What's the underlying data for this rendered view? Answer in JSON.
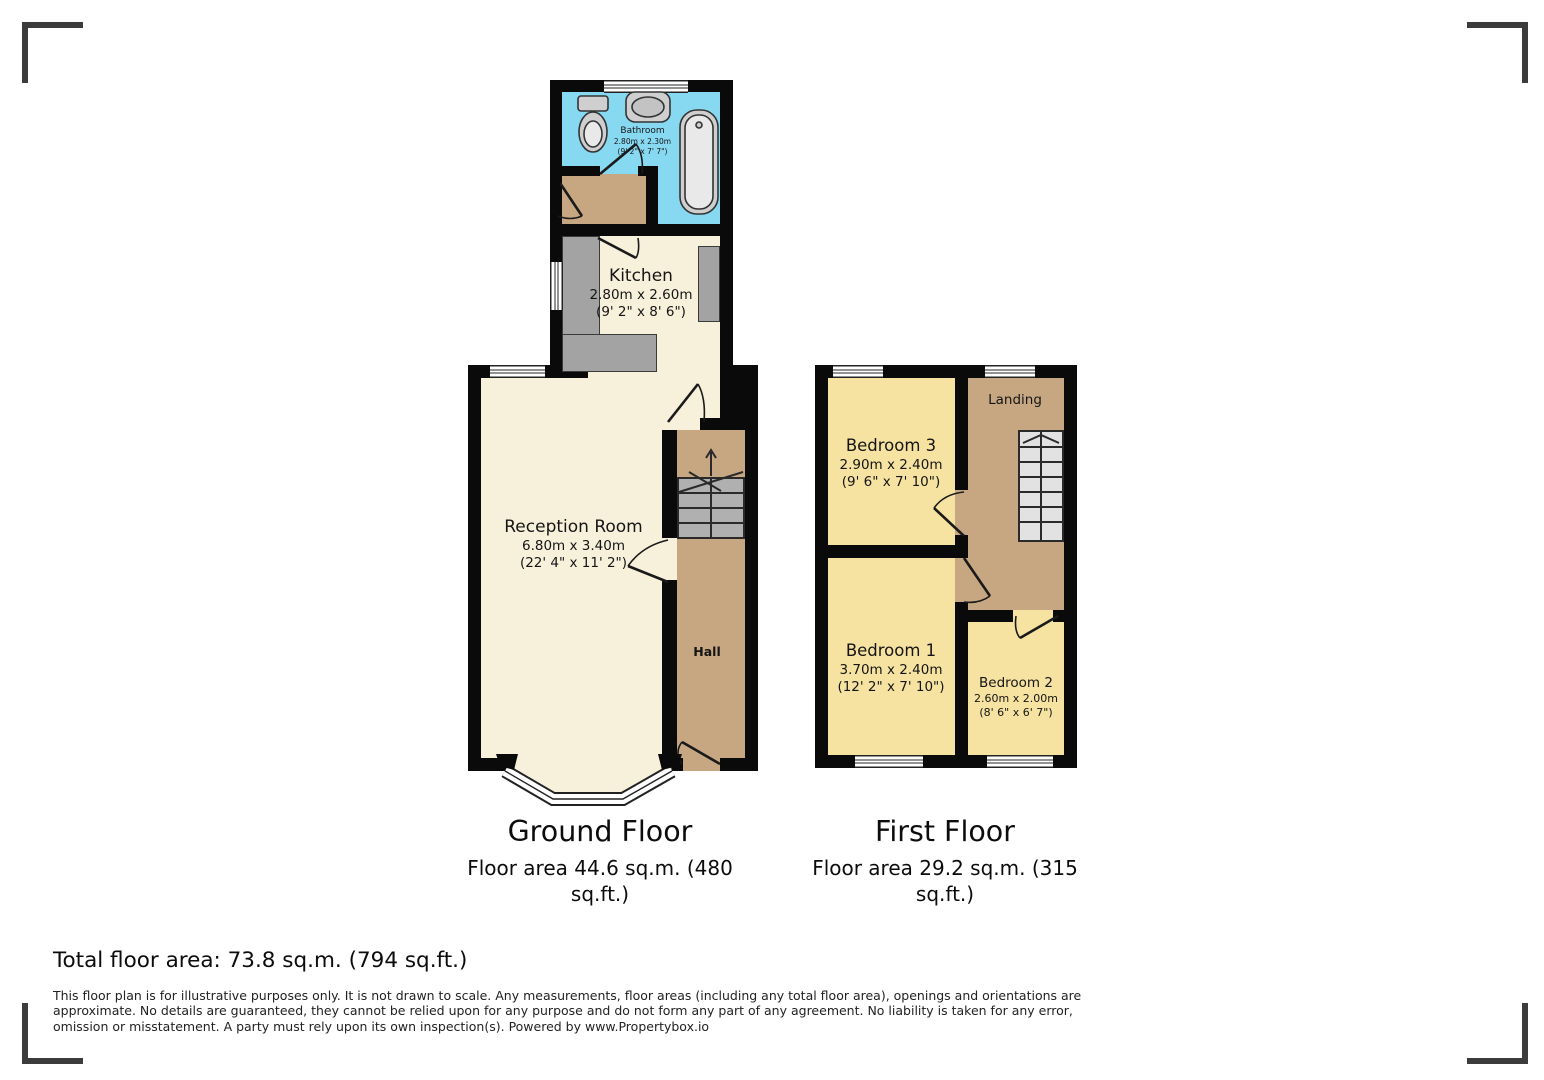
{
  "colors": {
    "wall": "#0a0a0a",
    "bathroom_blue": "#87d9f2",
    "floor_cream": "#f7f1dc",
    "bedroom_yellow": "#f6e3a1",
    "hall_tan": "#c7a682",
    "counter_gray": "#a3a3a3",
    "stair_gray": "#b0b0b0",
    "stair_light": "#e2e2e2",
    "crop_mark_gray": "#3c3c3c"
  },
  "ground_floor": {
    "title": "Ground Floor",
    "area": "Floor area 44.6 sq.m. (480 sq.ft.)",
    "rooms": {
      "bathroom": {
        "name": "Bathroom",
        "metric": "2.80m x 2.30m",
        "imperial": "(9' 2\" x 7' 7\")"
      },
      "kitchen": {
        "name": "Kitchen",
        "metric": "2.80m x 2.60m",
        "imperial": "(9' 2\" x 8' 6\")"
      },
      "reception": {
        "name": "Reception Room",
        "metric": "6.80m x 3.40m",
        "imperial": "(22' 4\" x 11' 2\")"
      },
      "hall": {
        "name": "Hall"
      }
    }
  },
  "first_floor": {
    "title": "First Floor",
    "area": "Floor area 29.2 sq.m. (315 sq.ft.)",
    "rooms": {
      "bedroom3": {
        "name": "Bedroom 3",
        "metric": "2.90m x 2.40m",
        "imperial": "(9' 6\" x 7' 10\")"
      },
      "landing": {
        "name": "Landing"
      },
      "bedroom1": {
        "name": "Bedroom 1",
        "metric": "3.70m x 2.40m",
        "imperial": "(12' 2\" x 7' 10\")"
      },
      "bedroom2": {
        "name": "Bedroom 2",
        "metric": "2.60m x 2.00m",
        "imperial": "(8' 6\" x 6' 7\")"
      }
    }
  },
  "footer": {
    "total_area": "Total floor area: 73.8 sq.m. (794 sq.ft.)",
    "disclaimer": "This floor plan is for illustrative purposes only. It is not drawn to scale. Any measurements, floor areas (including any total floor area), openings and orientations are approximate. No details are guaranteed, they cannot be relied upon for any purpose and do not form any part of any agreement. No liability is taken for any error, omission or misstatement. A party must rely upon its own inspection(s). Powered by www.Propertybox.io"
  }
}
